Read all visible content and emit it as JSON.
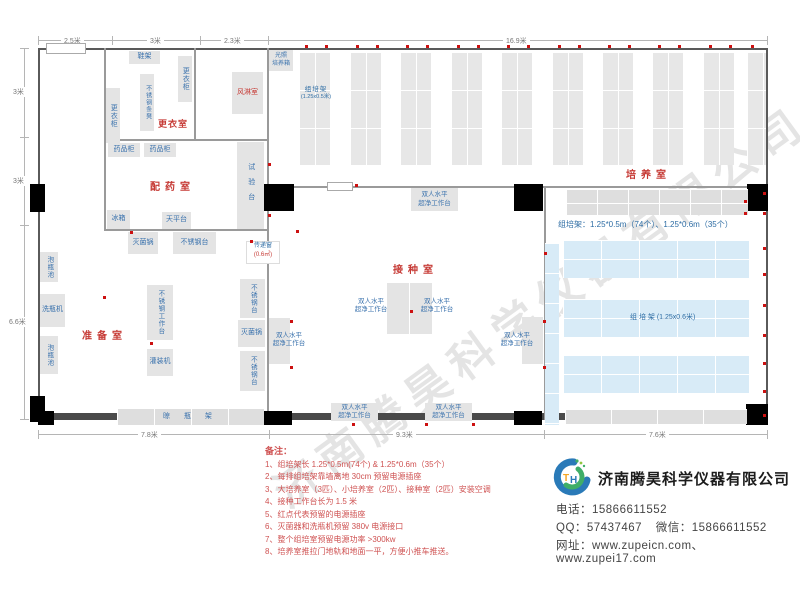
{
  "watermark": "济南腾昊科学仪器有限公司",
  "dims": {
    "top": [
      "2.5米",
      "3米",
      "2.3米",
      "16.9米"
    ],
    "left": [
      "3米",
      "3米",
      "6.6米"
    ],
    "bottom": [
      "7.8米",
      "9.3米",
      "7.6米"
    ]
  },
  "rooms": {
    "changing_room": "更衣室",
    "air_shower": "风淋室",
    "dispensing_room": "配药室",
    "prep_room": "准备室",
    "inoculation_room": "接种室",
    "culture_room": "培养室"
  },
  "equipment": {
    "shoe_rack": "鞋架",
    "locker": "更衣柜",
    "steel_bench": "不锈钢条凳",
    "medicine_cabinet": "药品柜",
    "test_bench": "试验台",
    "fridge": "冰箱",
    "balance_table": "天平台",
    "sterilizer": "灭菌锅",
    "steel_table": "不锈钢台",
    "steel_worktable": "不锈钢工作台",
    "filling_machine": "灌装机",
    "bottle_washer": "洗瓶机",
    "soaking_pool": "泡瓶池",
    "drying_rack": "晾 瓶 架",
    "pass_window": "传递窗",
    "pass_window_size": "(0.6㎡)",
    "clean_bench_l1": "双人水平",
    "clean_bench_l2": "超净工作台",
    "light_incubator_l1": "光照",
    "light_incubator_l2": "培养箱"
  },
  "racks": {
    "shelf_label": "组培架",
    "shelf_size_small": "(1.25x0.5米)",
    "shelf_label_06": "组 培 架 (1.25x0.6米)",
    "summary": "组培架：1.25*0.5m（74个）、1.25*0.6m（35个）"
  },
  "notes": {
    "title": "备注：",
    "items": [
      "1、组培架长 1.25*0.5m(74个) & 1.25*0.6m（35个）",
      "2、每排组培架靠墙离地 30cm 预留电源插座",
      "3、大培养室（3匹）、小培养室（2匹）、接种室（2匹）安装空调",
      "4、接种工作台长为 1.5 米",
      "5、红点代表预留的电源插座",
      "6、灭菌器和洗瓶机预留 380v 电源接口",
      "7、整个组培室预留电源功率 >300kw",
      "8、培养室推拉门地轨和地面一平，方便小推车推送。"
    ]
  },
  "company": {
    "name": "济南腾昊科学仪器有限公司",
    "phone_label": "电话：",
    "phone": "15866611552",
    "qq_label": "QQ：",
    "qq": "57437467",
    "wechat_label": "微信：",
    "wechat": "15866611552",
    "web_label": "网址：",
    "web1": "www.zupeicn.com",
    "web_sep": "、",
    "web2": "www.zupei17.com"
  },
  "colors": {
    "outlet_dot": "#cc1111",
    "room_label_red": "#c63a35",
    "equipment_text_blue": "#3a72ad",
    "rack_blue_fill": "#d8ebf7",
    "notes_red": "#cf5252"
  }
}
